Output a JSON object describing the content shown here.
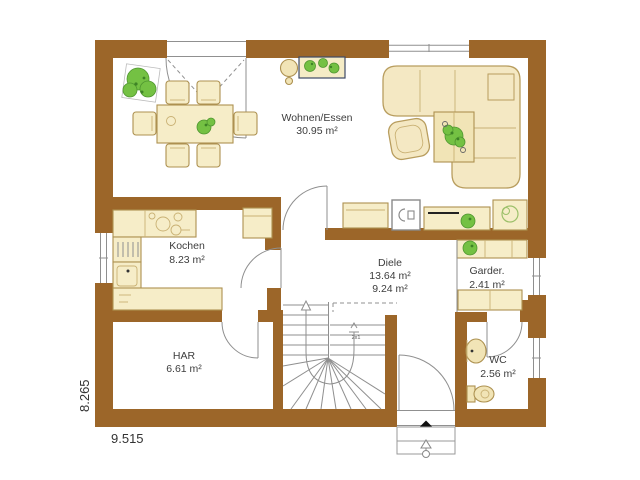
{
  "rooms": {
    "wohnen_essen": {
      "label": "Wohnen/Essen",
      "area": "30.95 m²"
    },
    "kochen": {
      "label": "Kochen",
      "area": "8.23 m²"
    },
    "diele": {
      "label": "Diele",
      "area1": "13.64 m²",
      "area2": "9.24 m²"
    },
    "garderobe": {
      "label": "Garder.",
      "area": "2.41 m²"
    },
    "har": {
      "label": "HAR",
      "area": "6.61 m²"
    },
    "wc": {
      "label": "WC",
      "area": "2.56 m²"
    }
  },
  "dimensions": {
    "bottom": "9.515",
    "left": "8.265"
  },
  "stairs": {
    "note": "2x1"
  },
  "colors": {
    "wall": "#9C6629",
    "furniture_fill": "#F6EDC8",
    "furniture_border": "#AD9150",
    "plant_green": "#74C143",
    "line_gray": "#8f8f8f",
    "text": "#3D3D3D"
  }
}
